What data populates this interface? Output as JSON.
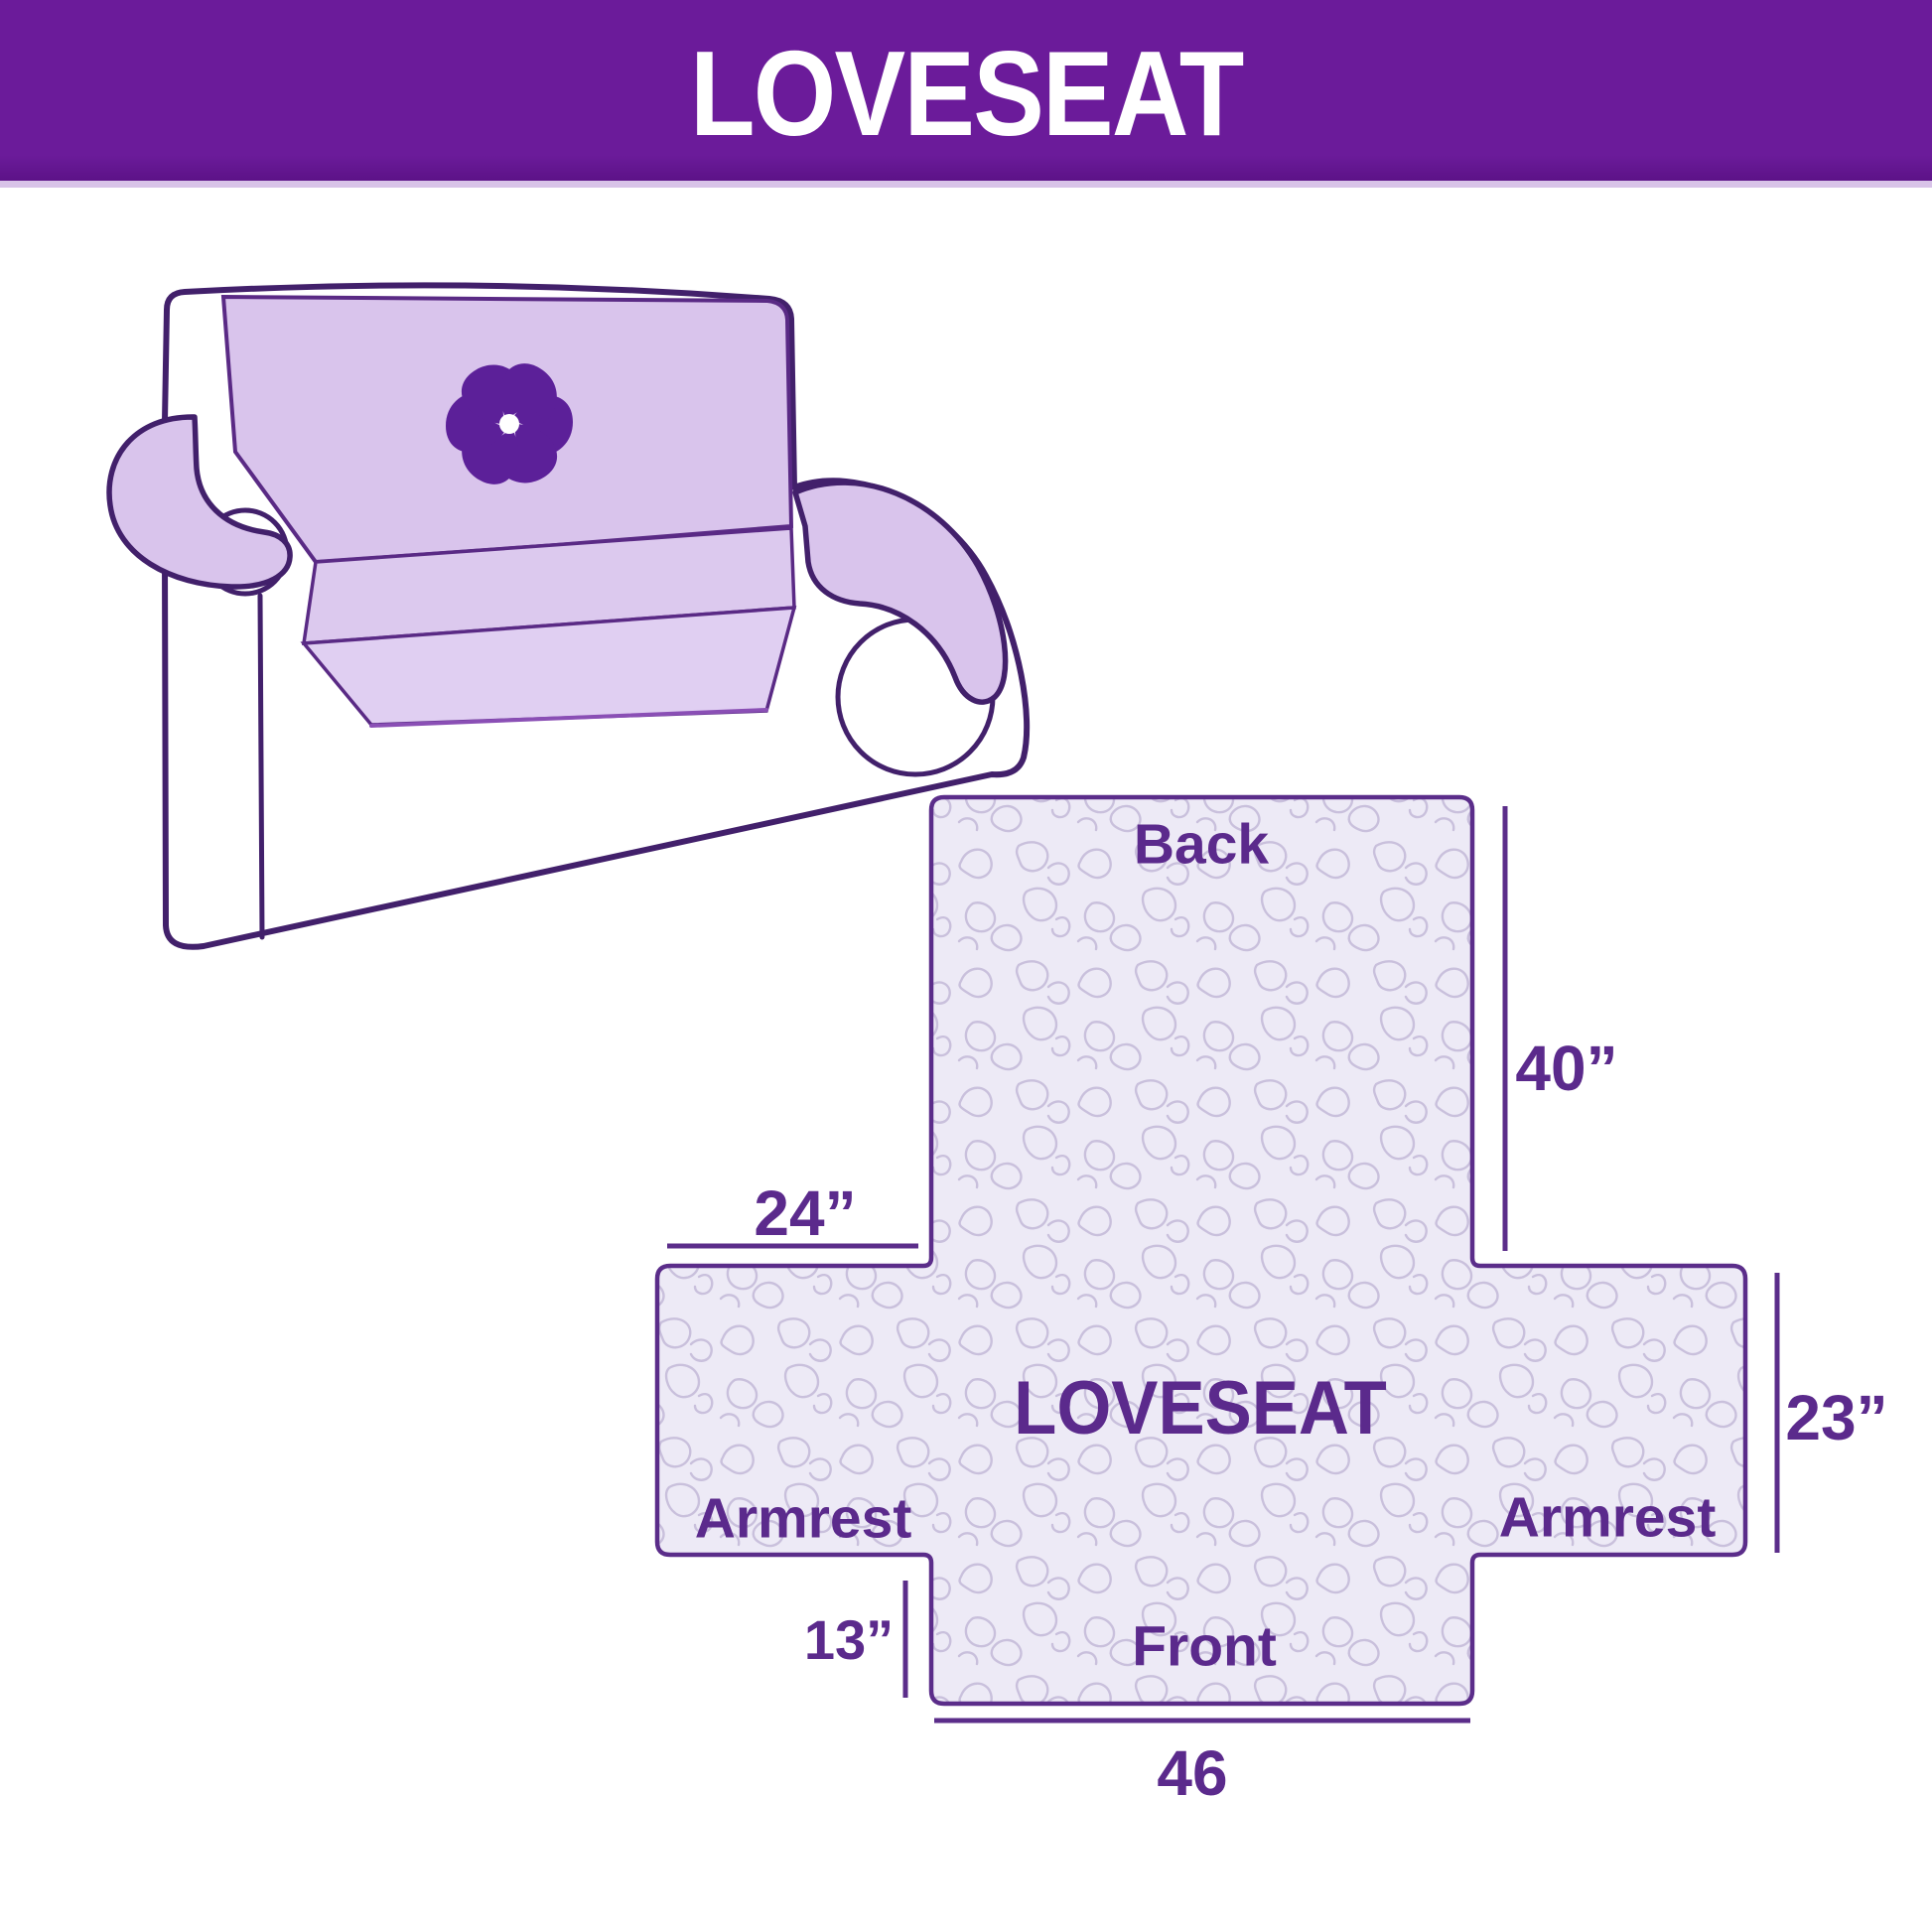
{
  "banner": {
    "title": "LOVESEAT",
    "bg_color": "#6b1b9a",
    "strip_color": "#d8c3e8",
    "text_color": "#ffffff"
  },
  "illustration": {
    "subject": "loveseat sofa with quilted slipcover",
    "cover_color": "#d9c4ec",
    "outline_color": "#42206b",
    "logo": "pinwheel-flower",
    "logo_color": "#5c2099"
  },
  "diagram": {
    "shape": "flattened cover cross layout",
    "border_color": "#5b2d8a",
    "fill_color": "#edeaf6",
    "pattern_color": "#c9c0dc",
    "label_color": "#5b2a8c",
    "labels": {
      "back": "Back",
      "center": "LOVESEAT",
      "armrest_left": "Armrest",
      "armrest_right": "Armrest",
      "front": "Front"
    },
    "dims": {
      "back_height": "40”",
      "armrest_width": "24”",
      "armrest_height": "23”",
      "front_drop": "13”",
      "front_width": "46"
    }
  }
}
